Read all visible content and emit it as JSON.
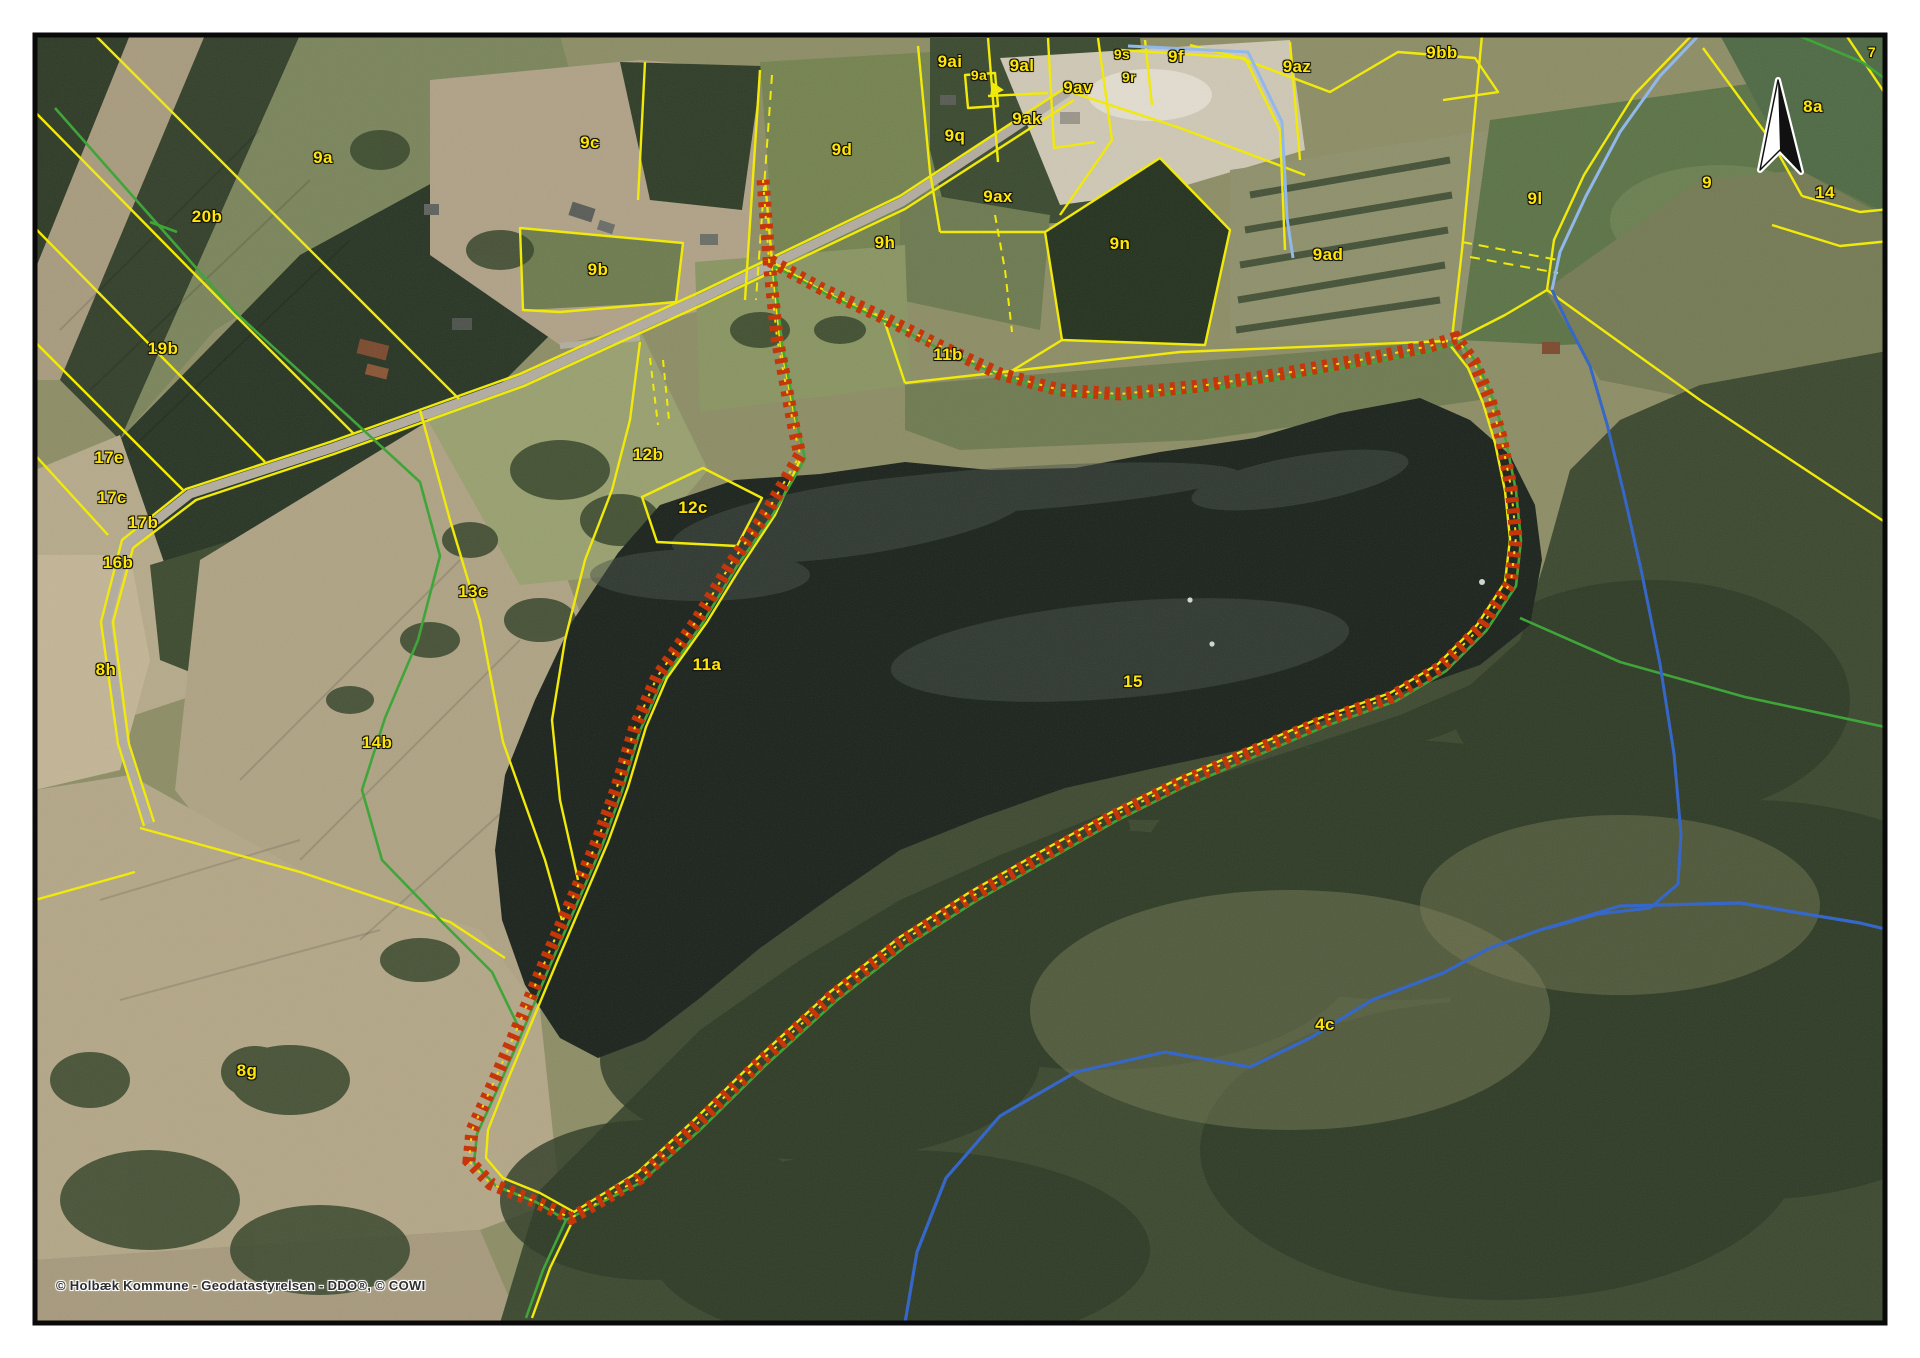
{
  "map": {
    "type": "cadastral-aerial-orthophoto-map",
    "copyright": "© Holbæk Kommune - Geodatastyrelsen - DDO®, © COWI",
    "lake_parcel_number": "15",
    "north_arrow": "north-arrow",
    "legend_colors": {
      "parcel_boundary_yellow": "#f4ec00",
      "protected_area_boundary_red": "#c62f00",
      "protected_area_center_dots": "#ffdd00",
      "path_line_green": "#39a433",
      "stream_line_blue": "#2f63c9",
      "stream_line_light_blue": "#8fb8ec",
      "label_text": "#ffe60a",
      "map_frame": "#0a0a0a"
    },
    "labels": [
      {
        "text": "9a",
        "x": 323,
        "y": 158
      },
      {
        "text": "20b",
        "x": 207,
        "y": 217
      },
      {
        "text": "19b",
        "x": 163,
        "y": 349
      },
      {
        "text": "17e",
        "x": 109,
        "y": 458
      },
      {
        "text": "17c",
        "x": 112,
        "y": 498
      },
      {
        "text": "17b",
        "x": 143,
        "y": 523
      },
      {
        "text": "16b",
        "x": 118,
        "y": 563
      },
      {
        "text": "8h",
        "x": 106,
        "y": 670
      },
      {
        "text": "14b",
        "x": 377,
        "y": 743
      },
      {
        "text": "8g",
        "x": 247,
        "y": 1071
      },
      {
        "text": "13c",
        "x": 473,
        "y": 592
      },
      {
        "text": "12b",
        "x": 648,
        "y": 455
      },
      {
        "text": "12c",
        "x": 693,
        "y": 508
      },
      {
        "text": "11a",
        "x": 707,
        "y": 665
      },
      {
        "text": "9c",
        "x": 590,
        "y": 143
      },
      {
        "text": "9b",
        "x": 598,
        "y": 270
      },
      {
        "text": "9d",
        "x": 842,
        "y": 150
      },
      {
        "text": "9q",
        "x": 955,
        "y": 136
      },
      {
        "text": "9ai",
        "x": 950,
        "y": 62
      },
      {
        "text": "9a",
        "x": 979,
        "y": 75,
        "small": true
      },
      {
        "text": "9al",
        "x": 1022,
        "y": 66
      },
      {
        "text": "9av",
        "x": 1078,
        "y": 88
      },
      {
        "text": "9ak",
        "x": 1027,
        "y": 119
      },
      {
        "text": "9s",
        "x": 1122,
        "y": 54,
        "small": true
      },
      {
        "text": "9r",
        "x": 1129,
        "y": 77,
        "small": true
      },
      {
        "text": "9f",
        "x": 1176,
        "y": 57
      },
      {
        "text": "9az",
        "x": 1297,
        "y": 67
      },
      {
        "text": "9bb",
        "x": 1442,
        "y": 53
      },
      {
        "text": "9ax",
        "x": 998,
        "y": 197
      },
      {
        "text": "9h",
        "x": 885,
        "y": 243
      },
      {
        "text": "9n",
        "x": 1120,
        "y": 244
      },
      {
        "text": "9ad",
        "x": 1328,
        "y": 255
      },
      {
        "text": "9l",
        "x": 1535,
        "y": 199
      },
      {
        "text": "9",
        "x": 1707,
        "y": 183
      },
      {
        "text": "8a",
        "x": 1813,
        "y": 107
      },
      {
        "text": "14",
        "x": 1825,
        "y": 193
      },
      {
        "text": "7",
        "x": 1872,
        "y": 52,
        "small": true
      },
      {
        "text": "11b",
        "x": 948,
        "y": 355
      },
      {
        "text": "15",
        "x": 1133,
        "y": 682
      },
      {
        "text": "4c",
        "x": 1325,
        "y": 1025
      }
    ]
  }
}
